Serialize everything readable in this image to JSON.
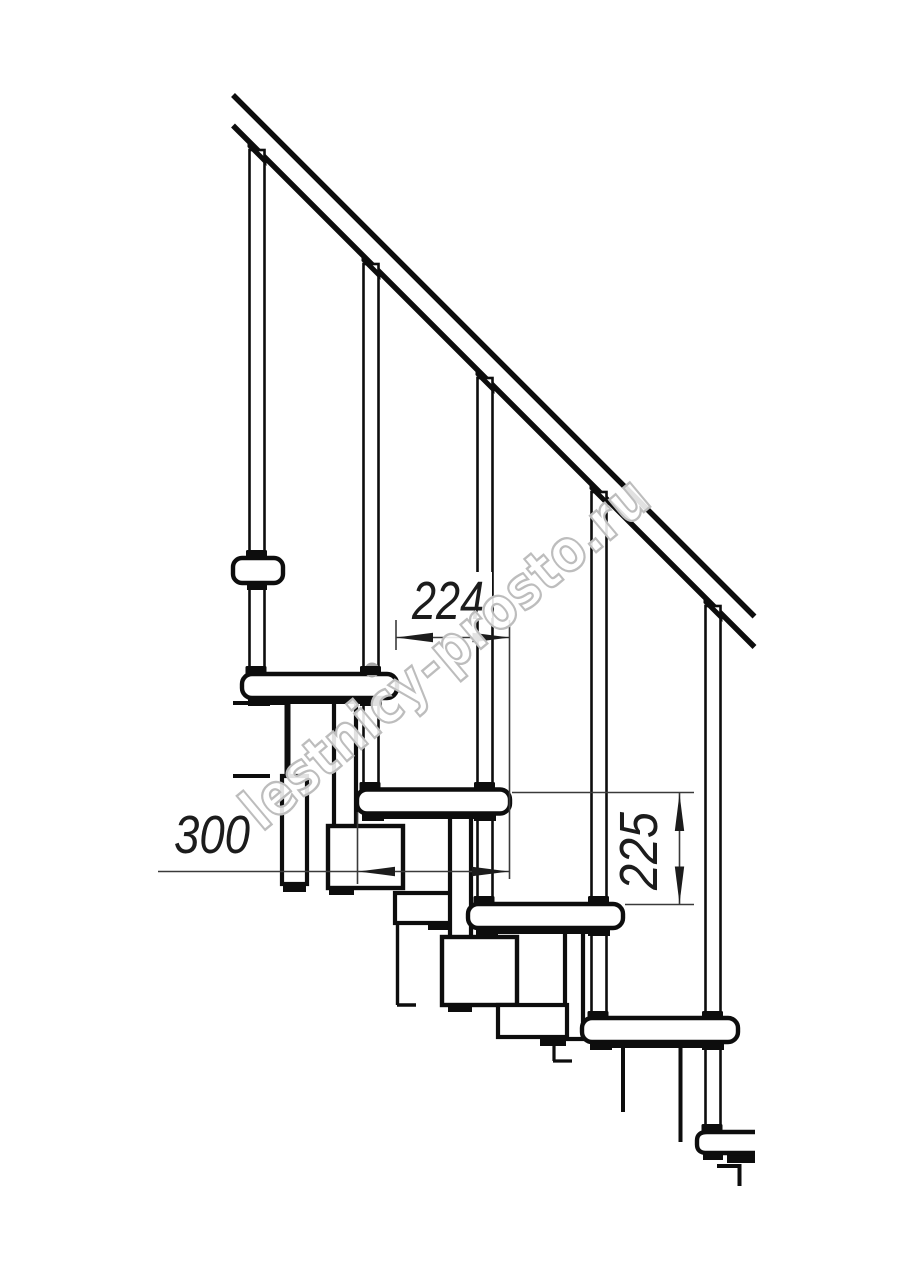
{
  "drawing": {
    "watermark_text": "lestnicy-prosto.ru",
    "dimensions": {
      "run": "224",
      "tread_depth": "300",
      "rise": "225"
    },
    "colors": {
      "background": "#ffffff",
      "line": "#0d0d0d",
      "dimension_line": "#3a3a3a",
      "arrow": "#1c1c1c",
      "watermark_fill": "#ffffff",
      "watermark_outline": "#bdbdbd",
      "joint_gray": "#a6a6a6"
    }
  }
}
